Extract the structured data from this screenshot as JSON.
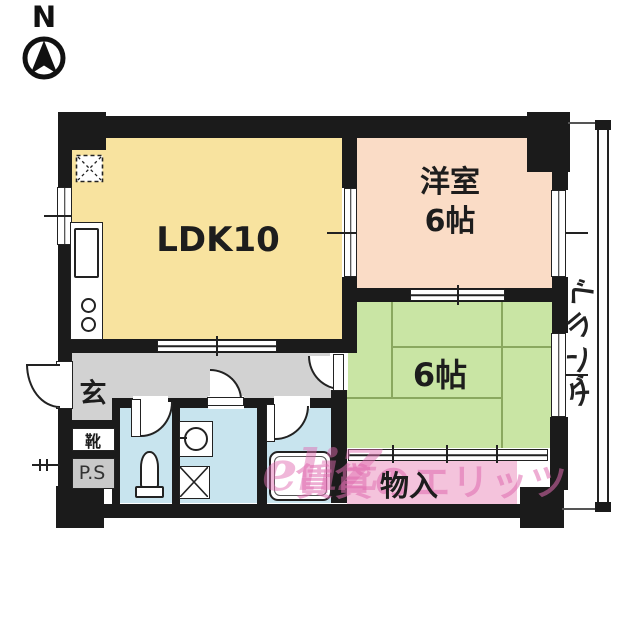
{
  "compass": {
    "north_label": "N"
  },
  "rooms": {
    "ldk": {
      "label": "LDK10"
    },
    "western": {
      "label": "洋室\n6帖"
    },
    "tatami": {
      "label": "6帖"
    },
    "storage": {
      "label": "物入"
    },
    "entrance": {
      "label": "玄"
    },
    "shoe": {
      "label": "靴"
    },
    "pipe_space": {
      "label": "P.S"
    },
    "veranda": {
      "label": "ベランダ",
      "chars": [
        "ベ",
        "ラ",
        "ン",
        "ダ"
      ]
    }
  },
  "watermark": {
    "logo": "eliƵ",
    "text": "賃貸のエリッツ"
  },
  "colors": {
    "wall": "#1b1b1b",
    "line": "#222222",
    "ldk": "#f8e39f",
    "western": "#fadcc6",
    "tatami": "#c9e5a4",
    "tatami-line": "#8aa85f",
    "storage": "#f4c3dc",
    "wet": "#c8e4ee",
    "hall": "#d2d2d2",
    "ps": "#c9c9c9",
    "watermark": "#e06bb0"
  }
}
